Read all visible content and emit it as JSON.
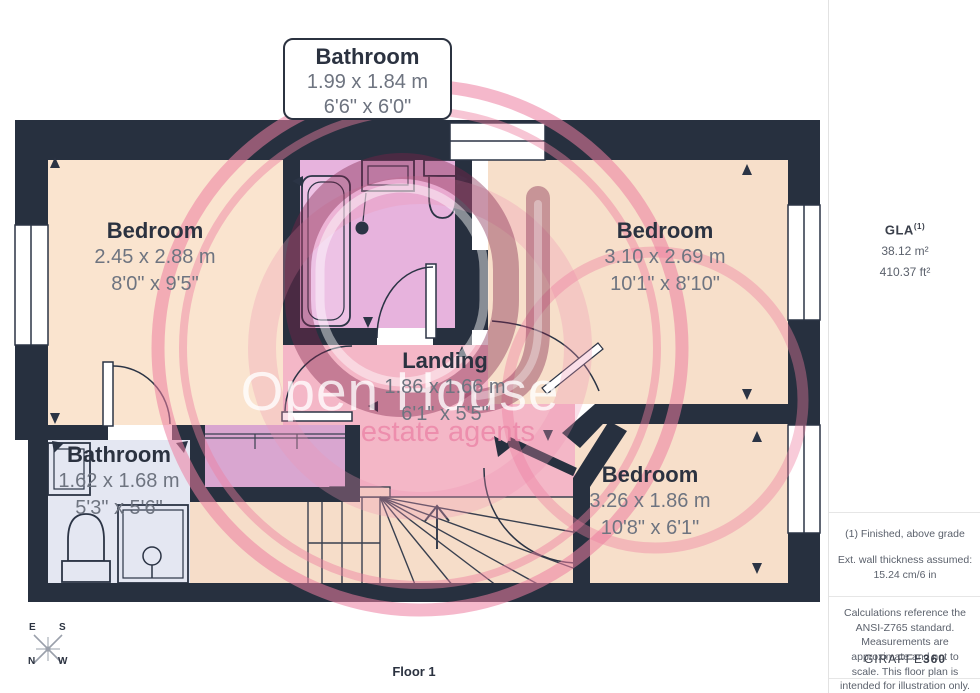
{
  "plan": {
    "callout": {
      "name": "Bathroom",
      "metric": "1.99 x 1.84 m",
      "imperial": "6'6\" x 6'0\""
    },
    "rooms": {
      "bedroom_left": {
        "name": "Bedroom",
        "metric": "2.45 x 2.88 m",
        "imperial": "8'0\" x 9'5\""
      },
      "bedroom_right": {
        "name": "Bedroom",
        "metric": "3.10 x 2.69 m",
        "imperial": "10'1\" x 8'10\""
      },
      "bedroom_bottom": {
        "name": "Bedroom",
        "metric": "3.26 x 1.86 m",
        "imperial": "10'8\" x 6'1\""
      },
      "landing": {
        "name": "Landing",
        "metric": "1.86 x 1.66 m",
        "imperial": "6'1\" x 5'5\""
      },
      "bathroom_small": {
        "name": "Bathroom",
        "metric": "1.62 x 1.68 m",
        "imperial": "5'3\" x 5'6\""
      }
    }
  },
  "watermark": {
    "line1": "Open House",
    "line2": "estate agents"
  },
  "compass": {
    "top_left": "E",
    "top_right": "S",
    "bottom_left": "N",
    "bottom_right": "W"
  },
  "footer": {
    "floor_label": "Floor 1"
  },
  "sidebar": {
    "gla_label": "GLA",
    "gla_note_ref": "(1)",
    "area_metric": "38.12 m²",
    "area_imperial": "410.37 ft²",
    "note_grade": "(1) Finished, above grade",
    "note_wall": "Ext. wall thickness assumed: 15.24 cm/6 in",
    "disclaimer": "Calculations reference the ANSI-Z765 standard. Measurements are approximate and not to scale. This floor plan is intended for illustration only.",
    "brand": "GIRAFFE",
    "brand_suffix": "360"
  },
  "palette": {
    "wall": "#27303f",
    "bedroom_floor": "#f7dfca",
    "bedroom_left_floor": "#fae4cf",
    "bathroom_top_floor": "#e7b3dd",
    "bathroom_small_floor": "#e4e7f2",
    "landing_floor": "#f4b7c7",
    "stairs_floor": "#f6ddc9",
    "wardrobe": "#d9a6d0",
    "watermark_pink": "#ed7ea0",
    "watermark_maroon": "#80224a"
  }
}
